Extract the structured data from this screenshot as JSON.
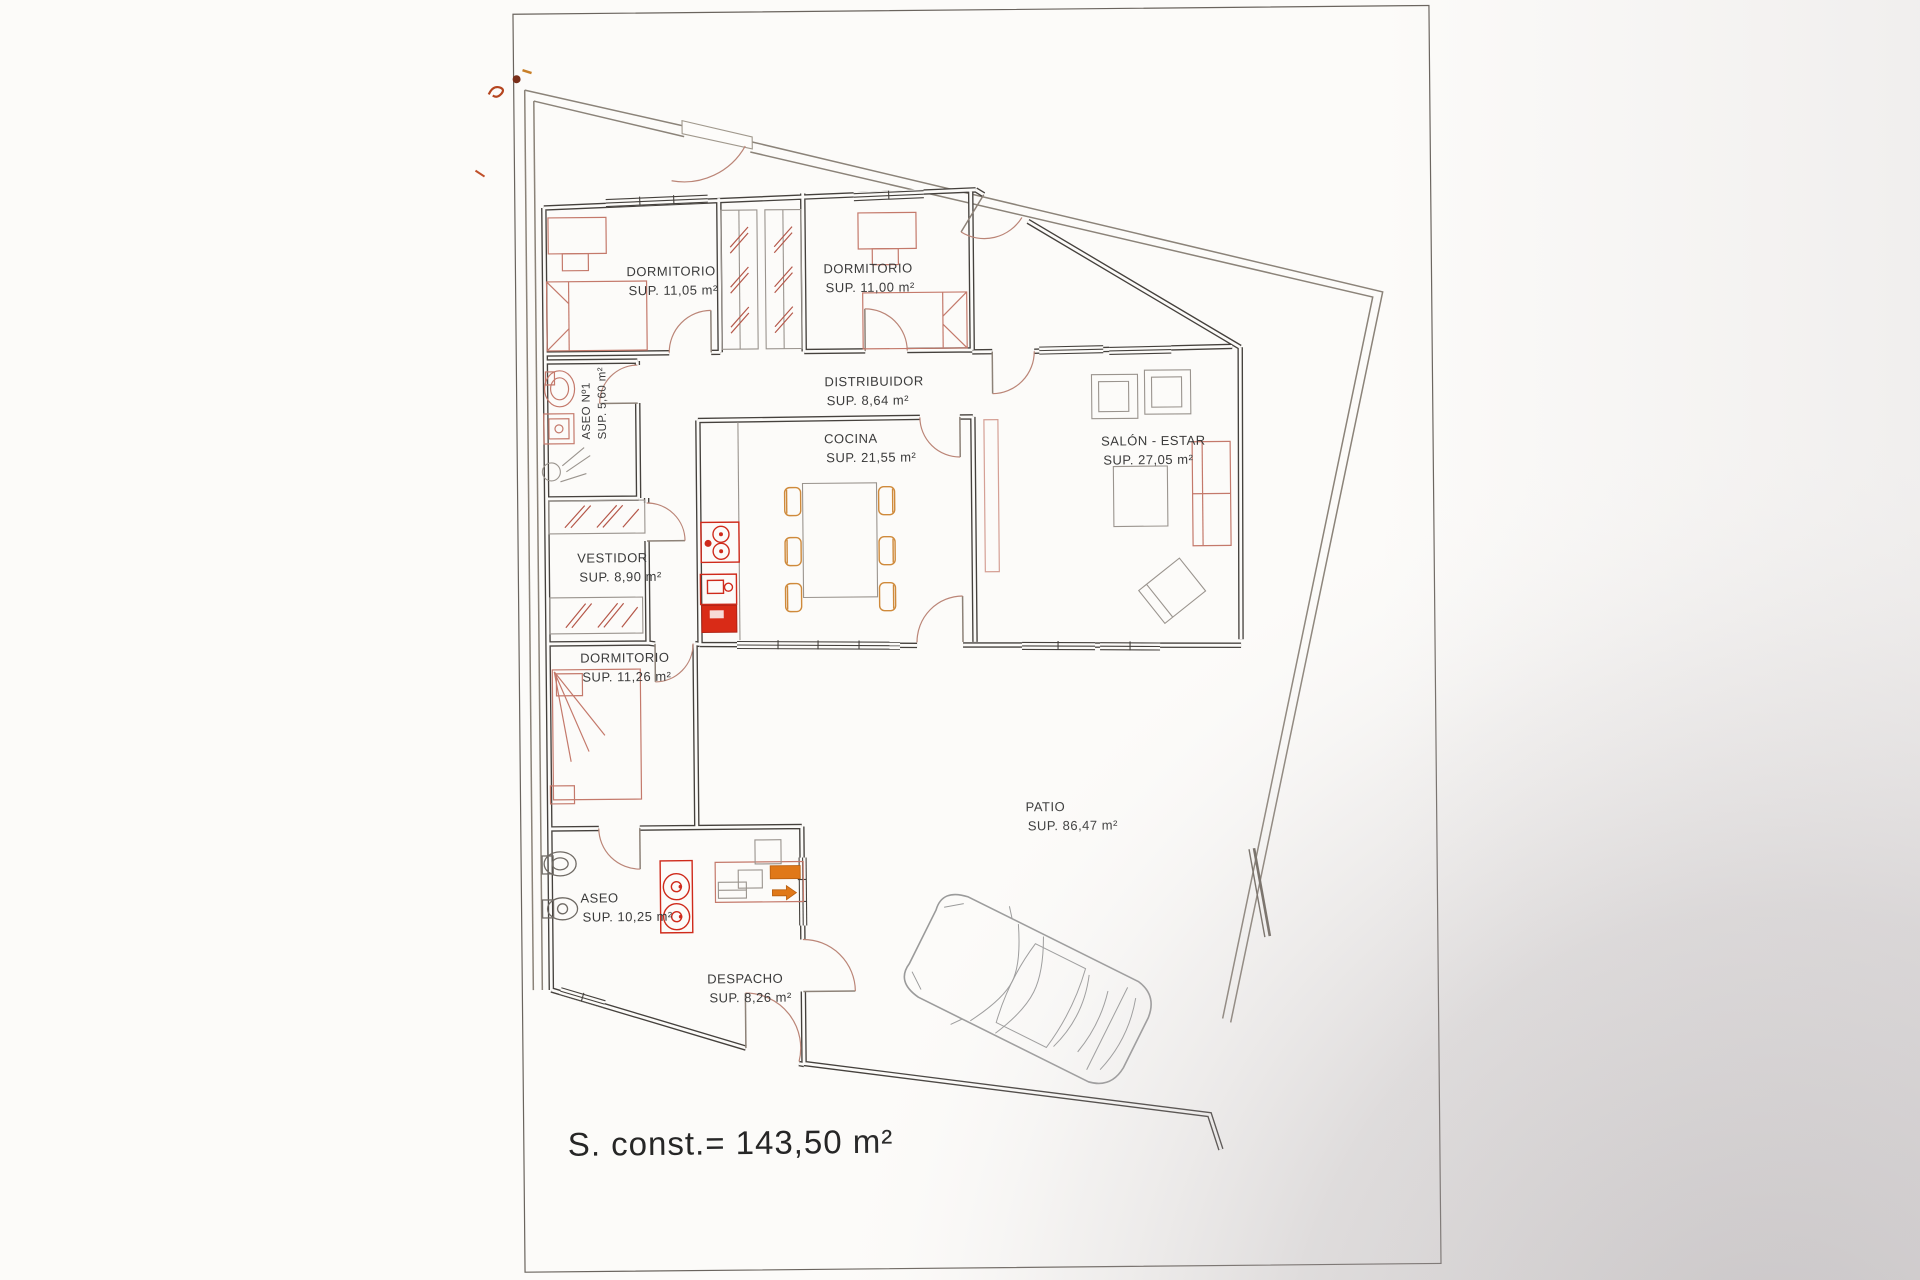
{
  "plan": {
    "rooms": [
      {
        "id": "dormitorio-1",
        "name": "DORMITORIO",
        "area": "SUP. 11,05 m²"
      },
      {
        "id": "dormitorio-2",
        "name": "DORMITORIO",
        "area": "SUP. 11,00 m²"
      },
      {
        "id": "distribuidor",
        "name": "DISTRIBUIDOR",
        "area": "SUP. 8,64 m²"
      },
      {
        "id": "cocina",
        "name": "COCINA",
        "area": "SUP. 21,55 m²"
      },
      {
        "id": "salon-estar",
        "name": "SALÓN - ESTAR",
        "area": "SUP. 27,05 m²"
      },
      {
        "id": "aseo-1",
        "name": "ASEO Nº1",
        "area": "SUP. 5,60 m²"
      },
      {
        "id": "vestidor",
        "name": "VESTIDOR",
        "area": "SUP. 8,90 m²"
      },
      {
        "id": "dormitorio-3",
        "name": "DORMITORIO",
        "area": "SUP. 11,26 m²"
      },
      {
        "id": "aseo-2",
        "name": "ASEO",
        "area": "SUP. 10,25 m²"
      },
      {
        "id": "despacho",
        "name": "DESPACHO",
        "area": "SUP. 8,26 m²"
      },
      {
        "id": "patio",
        "name": "PATIO",
        "area": "SUP. 86,47 m²"
      }
    ],
    "total_label": "S. const.= 143,50 m²"
  },
  "colors": {
    "wall": "#45413d",
    "boundary": "#8b8379",
    "furniture_salmon": "#c4796b",
    "appliance_red": "#d92b17",
    "chair_orange": "#cf8a3b",
    "highlight_orange": "#e07818",
    "label_text": "#3b3b3b",
    "paper": "#fcfbf9"
  },
  "icons": {
    "car": "top-view car outline in patio",
    "bed": "bed outline with fold lines",
    "wardrobe": "closet strip with red hatch marks",
    "toilet": "toilet bowl outline",
    "sink": "oval basin outline",
    "shower": "shower head with spray lines",
    "stove": "red hob with burners",
    "kitchen-sink": "red sink unit",
    "dining-table": "table with six chairs",
    "sofa": "sofa outline",
    "armchair": "square armchair outline",
    "coffee-table": "square table outline",
    "desk": "desk with monitor and printer",
    "door-swing": "quarter-circle door arc",
    "window": "triple-line window glyph"
  }
}
